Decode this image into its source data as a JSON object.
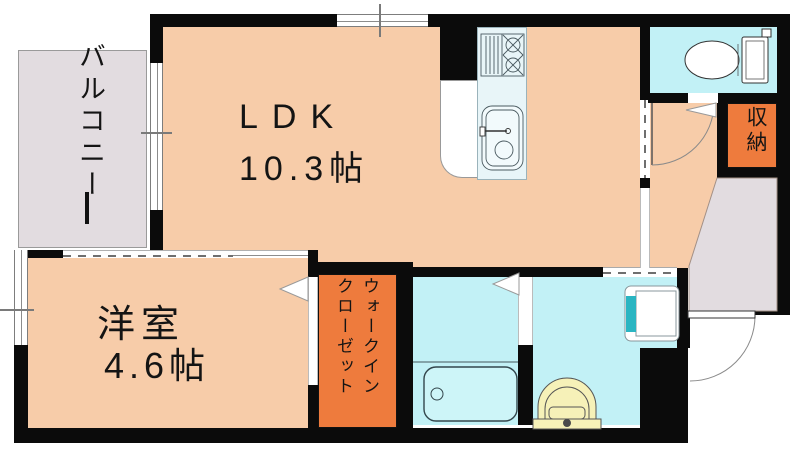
{
  "title": "1LDK floor plan",
  "rooms": {
    "ldk": {
      "label": "LDK",
      "size": "10.3帖"
    },
    "western_room": {
      "label": "洋室",
      "size": "4.6帖"
    },
    "balcony": {
      "label": "バルコニー"
    },
    "storage": {
      "label": "収納"
    },
    "walk_in_closet": {
      "label_lines": [
        "ウォークイン",
        "クローゼット"
      ]
    }
  },
  "fixtures": {
    "kitchen": [
      "gas-stove",
      "kitchen-sink"
    ],
    "bathroom": [
      "bathtub"
    ],
    "washroom": [
      "washbasin",
      "washing-machine-pan"
    ],
    "toilet_room": [
      "toilet"
    ]
  },
  "doors": [
    "entrance-swing-door",
    "toilet-swing-door",
    "western-room-opening-arrow",
    "bathroom-door-arrow",
    "sliding-door-dashed"
  ],
  "colors": {
    "wall": "#0b0b0b",
    "room_fill": "#f7cca9",
    "wet_fill": "#c2f1f6",
    "closet_fill": "#ee7b3d",
    "balcony_fill": "#e2dce0",
    "kitchen_fill": "#e8f5f8",
    "pan_teal": "#2ab5c2",
    "basin_yellow": "#f6f1b8"
  }
}
